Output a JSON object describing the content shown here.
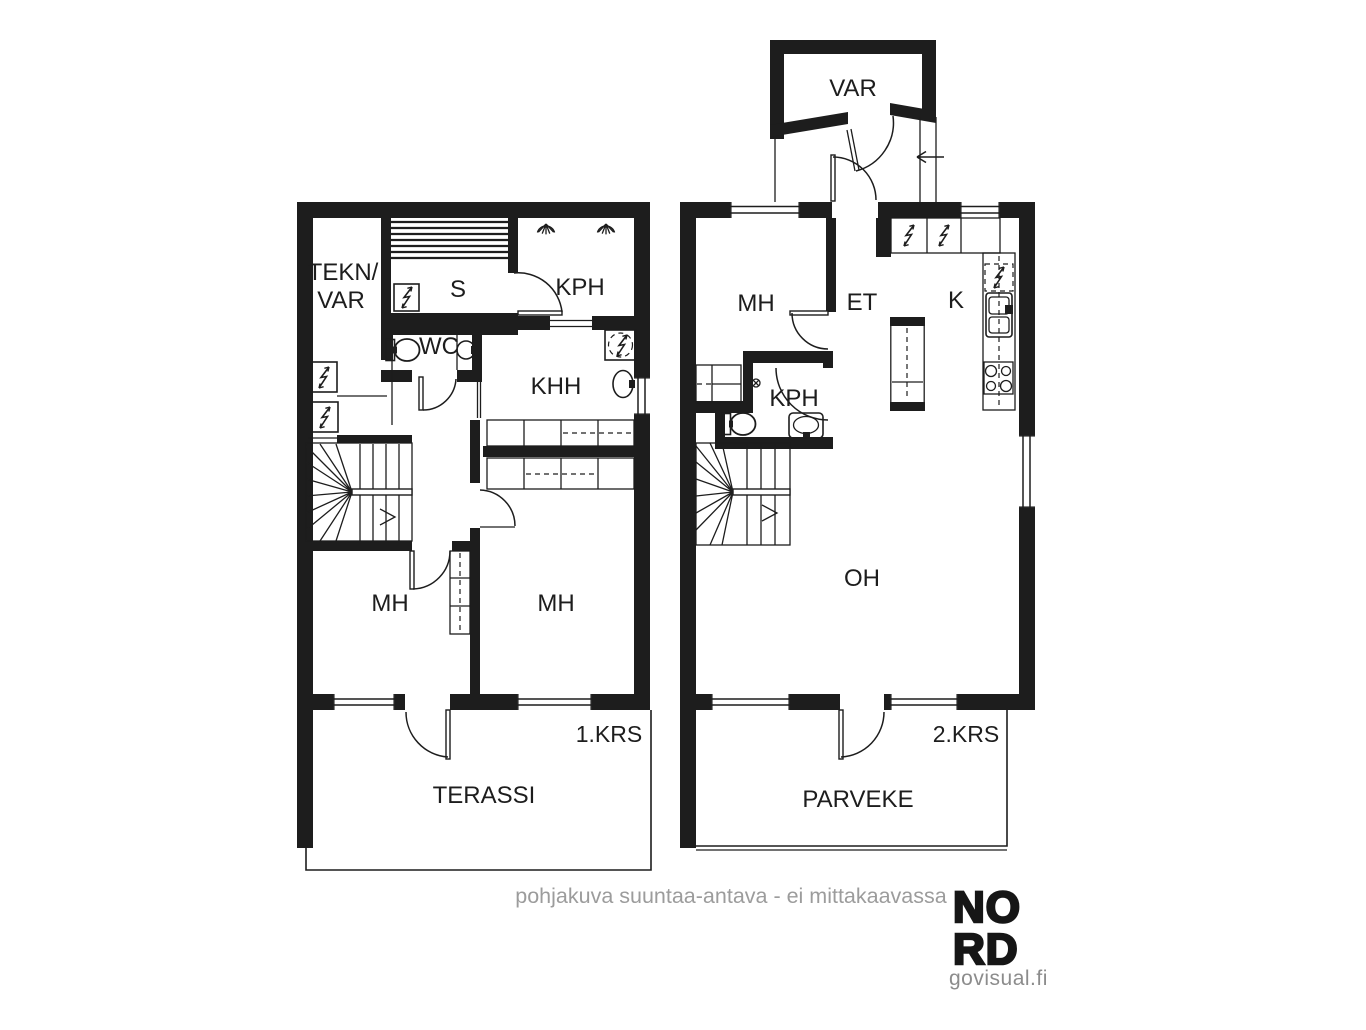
{
  "document": {
    "type": "floorplan"
  },
  "colors": {
    "ink": "#1d1d1d",
    "muted": "#9c9c9c",
    "logo_muted": "#8c8c8c",
    "background": "#ffffff"
  },
  "floor1": {
    "floor_label": "1.KRS",
    "rooms": {
      "tekn_var_line1": "TEKN/",
      "tekn_var_line2": "VAR",
      "sauna": "S",
      "bathroom": "KPH",
      "toilet": "WC",
      "utility": "KHH",
      "bedroom_left": "MH",
      "bedroom_right": "MH",
      "terrace": "TERASSI"
    }
  },
  "floor2": {
    "floor_label": "2.KRS",
    "rooms": {
      "storage": "VAR",
      "bedroom": "MH",
      "entry": "ET",
      "kitchen": "K",
      "bathroom": "KPH",
      "living": "OH",
      "balcony": "PARVEKE"
    }
  },
  "footer": {
    "disclaimer": "pohjakuva suuntaa-antava - ei mittakaavassa"
  },
  "logo": {
    "line1": "NO",
    "line2": "RD",
    "domain": "govisual.fi"
  }
}
